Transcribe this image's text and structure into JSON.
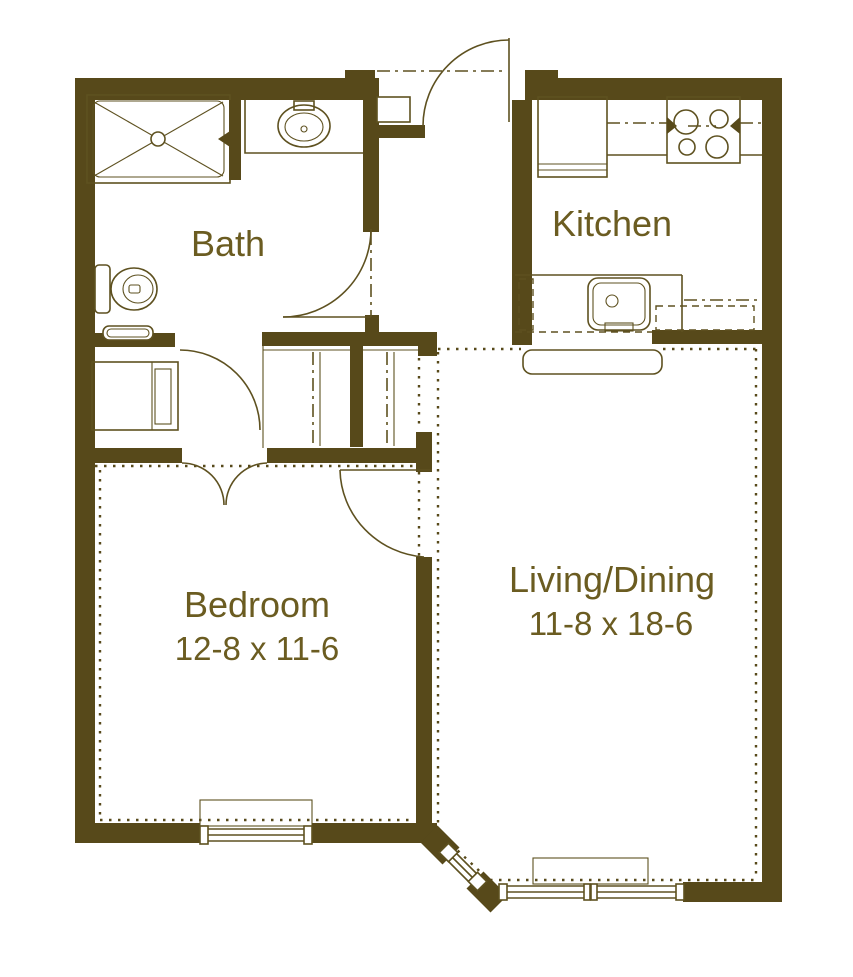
{
  "title": "One-bedroom apartment floor plan",
  "colors": {
    "wall": "#57491a",
    "line": "#5e5120",
    "text": "#6b5c21",
    "bg": "#ffffff"
  },
  "rooms": [
    {
      "id": "bath",
      "label": "Bath"
    },
    {
      "id": "kitchen",
      "label": "Kitchen"
    },
    {
      "id": "bedroom",
      "label": "Bedroom",
      "dimensions": "12-8 x 11-6"
    },
    {
      "id": "living_dining",
      "label": "Living/Dining",
      "dimensions": "11-8 x 18-6"
    }
  ],
  "fixtures": [
    "shower",
    "vanity-sink",
    "toilet",
    "towel-shelf",
    "washer-dryer",
    "refrigerator",
    "range-cooktop",
    "kitchen-sink",
    "breakfast-bar",
    "closet-rod-and-shelf",
    "entry-door",
    "bath-door",
    "bedroom-double-doors",
    "bedroom-door",
    "bedroom-window",
    "living-window",
    "bay-window"
  ]
}
